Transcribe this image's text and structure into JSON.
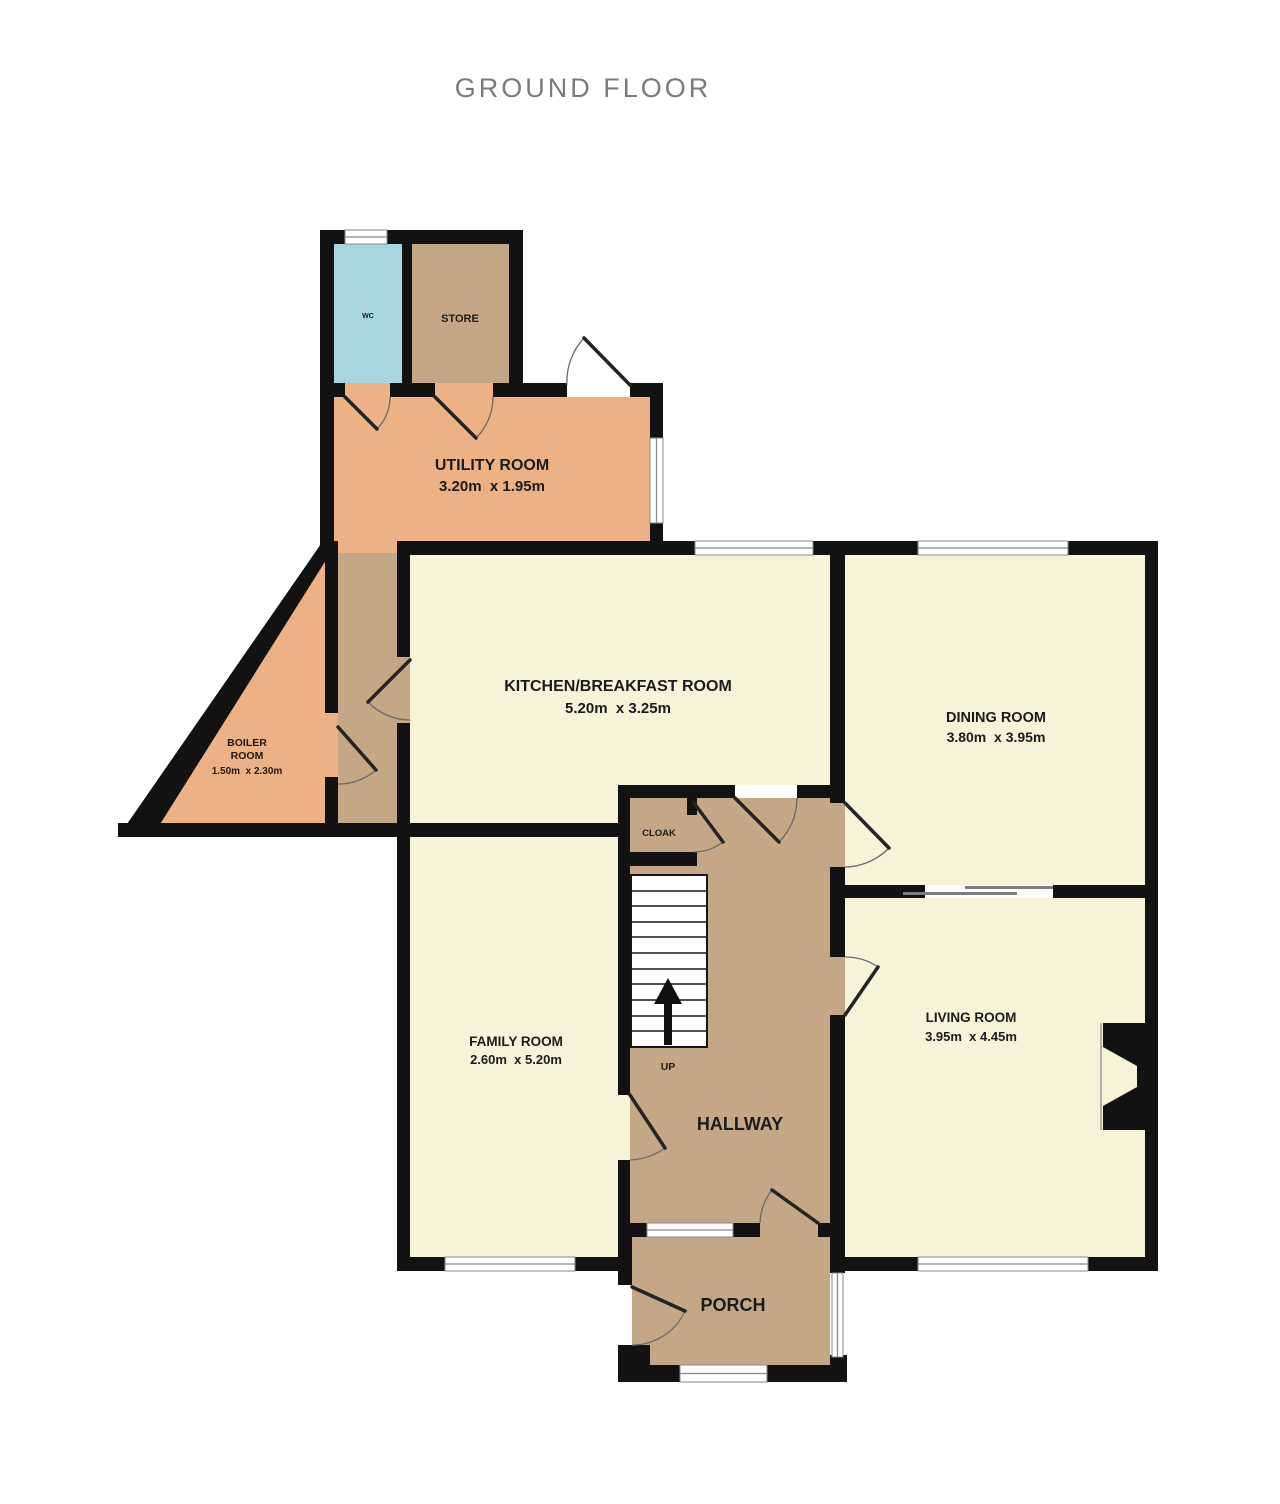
{
  "title": "GROUND FLOOR",
  "colors": {
    "wall": "#121212",
    "cream": "#f7f3d9",
    "tan": "#c4a787",
    "orange": "#ecb185",
    "blue": "#a9d5e1",
    "title_text": "#7b7b7b",
    "label_text": "#1b1b1b"
  },
  "rooms": {
    "wc": {
      "name": "WC"
    },
    "store": {
      "name": "STORE"
    },
    "utility_room": {
      "name": "UTILITY ROOM",
      "dimensions": "3.20m  x 1.95m"
    },
    "boiler_room": {
      "name_line1": "BOILER",
      "name_line2": "ROOM",
      "dimensions": "1.50m  x 2.30m"
    },
    "kitchen_breakfast_room": {
      "name": "KITCHEN/BREAKFAST ROOM",
      "dimensions": "5.20m  x 3.25m"
    },
    "dining_room": {
      "name": "DINING ROOM",
      "dimensions": "3.80m  x 3.95m"
    },
    "family_room": {
      "name": "FAMILY ROOM",
      "dimensions": "2.60m  x 5.20m"
    },
    "living_room": {
      "name": "LIVING ROOM",
      "dimensions": "3.95m  x 4.45m"
    },
    "hallway": {
      "name": "HALLWAY"
    },
    "cloak": {
      "name": "CLOAK"
    },
    "porch": {
      "name": "PORCH"
    },
    "stairs": {
      "label": "UP"
    }
  }
}
